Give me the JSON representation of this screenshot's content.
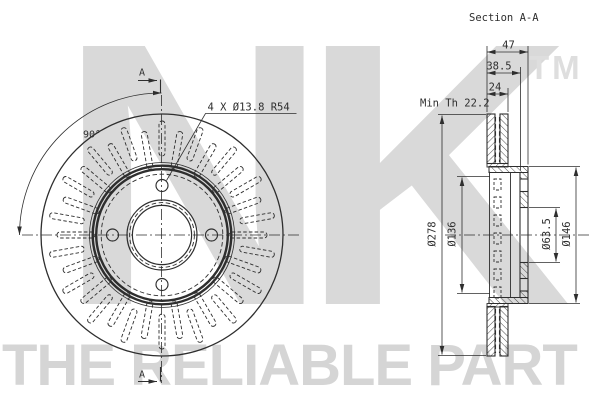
{
  "drawing": {
    "section_title": "Section A-A",
    "bolt_note": "4 X Ø13.8 R54",
    "angle_label": "90°",
    "cut_marker_top": "A",
    "cut_marker_bottom": "A",
    "min_thickness_note": "Min Th 22.2",
    "dims": {
      "overall_width": "47",
      "hat_depth": "38.5",
      "rotor_thickness": "24",
      "outer_diameter": "Ø278",
      "friction_inner_diameter": "Ø136",
      "center_bore_diameter": "Ø63.5",
      "hat_outer_diameter": "Ø146"
    }
  },
  "watermark": {
    "logo": "NK",
    "tm": "TM",
    "tagline": "THE RELIABLE PART"
  },
  "style": {
    "line_color": "#2e2e2e",
    "watermark_color": "#d9d9d9",
    "background": "#ffffff"
  },
  "front_view": {
    "vent_slot_count": 36,
    "bolt_hole_count": 4,
    "bolt_circle_radius": 49.5,
    "bolt_hole_radius": 6
  }
}
